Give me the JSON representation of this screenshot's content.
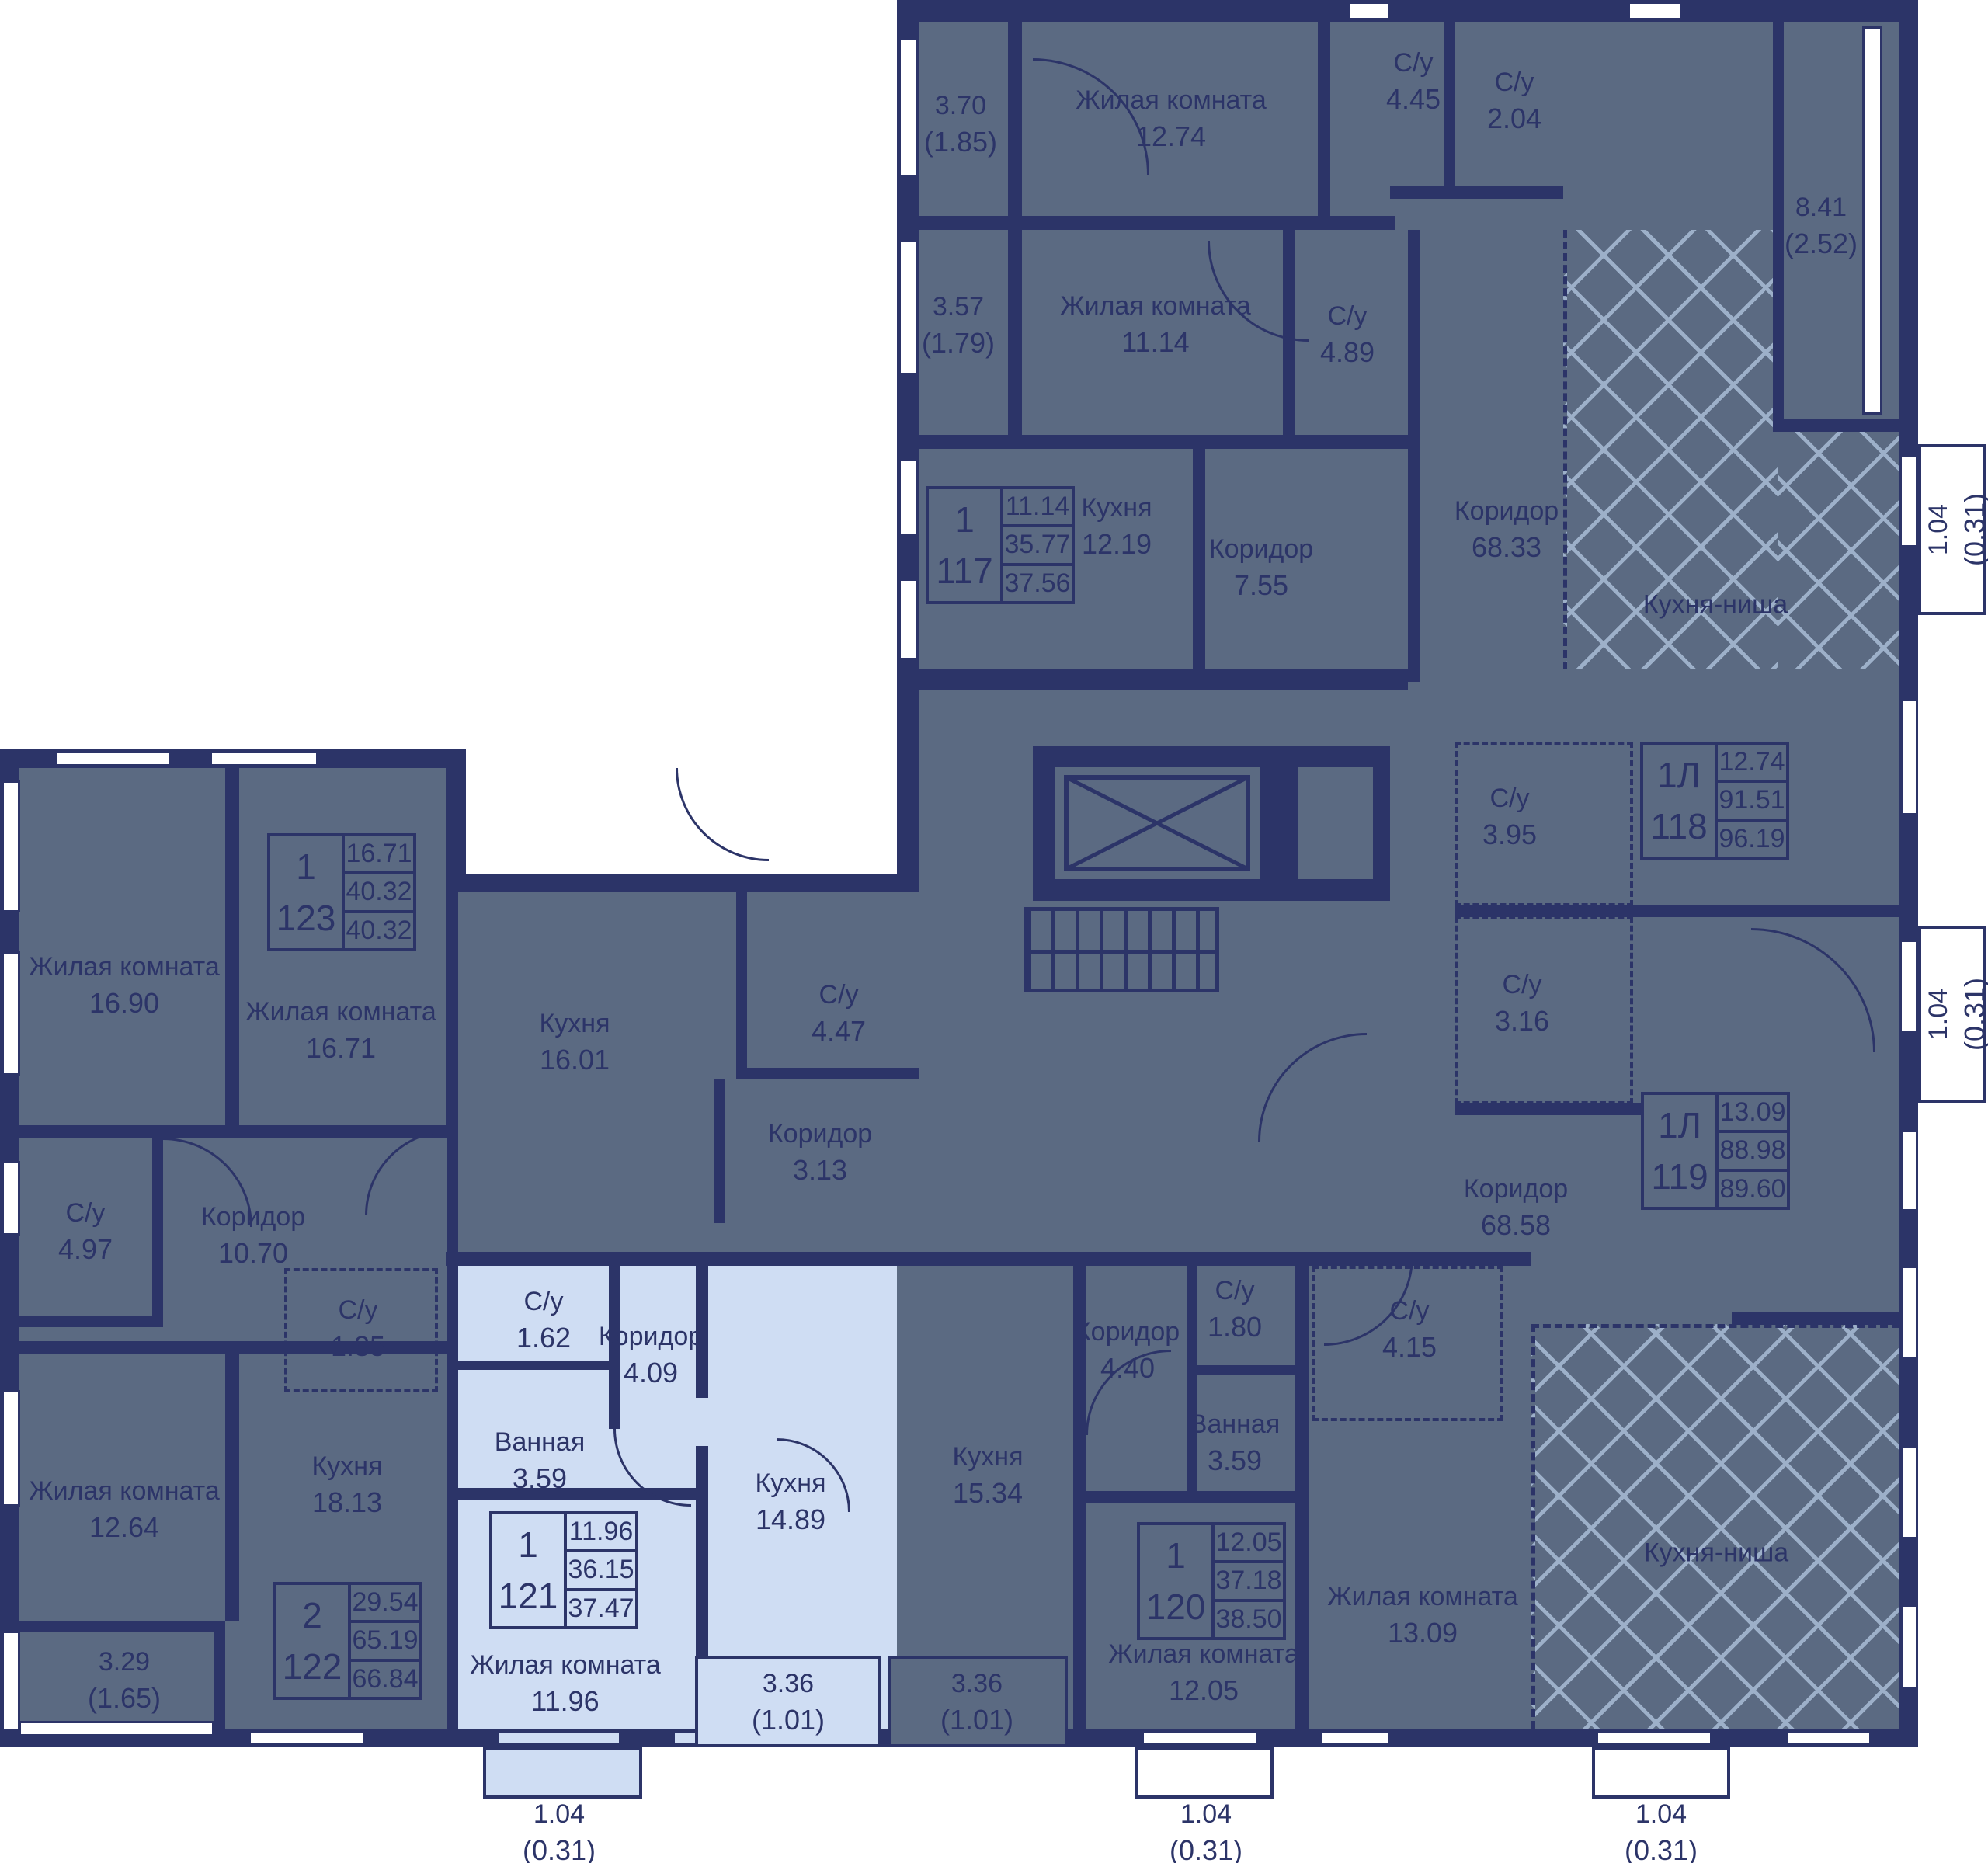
{
  "apartments": {
    "a117": {
      "type": "1",
      "number": "117",
      "living": "11.14",
      "area": "35.77",
      "total": "37.56"
    },
    "a118": {
      "type": "1Л",
      "number": "118",
      "living": "12.74",
      "area": "91.51",
      "total": "96.19"
    },
    "a119": {
      "type": "1Л",
      "number": "119",
      "living": "13.09",
      "area": "88.98",
      "total": "89.60"
    },
    "a120": {
      "type": "1",
      "number": "120",
      "living": "12.05",
      "area": "37.18",
      "total": "38.50"
    },
    "a121": {
      "type": "1",
      "number": "121",
      "living": "11.96",
      "area": "36.15",
      "total": "37.47"
    },
    "a122": {
      "type": "2",
      "number": "122",
      "living": "29.54",
      "area": "65.19",
      "total": "66.84"
    },
    "a123": {
      "type": "1",
      "number": "123",
      "living": "16.71",
      "area": "40.32",
      "total": "40.32"
    }
  },
  "rooms": {
    "zh1274": {
      "name": "Жилая комната",
      "area": "12.74"
    },
    "su445": {
      "name": "С/у",
      "area": "4.45"
    },
    "su204": {
      "name": "С/у",
      "area": "2.04"
    },
    "zh1114": {
      "name": "Жилая комната",
      "area": "11.14"
    },
    "su489": {
      "name": "С/у",
      "area": "4.89"
    },
    "k1219": {
      "name": "Кухня",
      "area": "12.19"
    },
    "kor755": {
      "name": "Коридор",
      "area": "7.55"
    },
    "kor6833": {
      "name": "Коридор",
      "area": "68.33"
    },
    "niche_top": {
      "name": "Кухня-ниша"
    },
    "su395": {
      "name": "С/у",
      "area": "3.95"
    },
    "su316": {
      "name": "С/у",
      "area": "3.16"
    },
    "kor6858": {
      "name": "Коридор",
      "area": "68.58"
    },
    "niche_bottom": {
      "name": "Кухня-ниша"
    },
    "zh1690": {
      "name": "Жилая комната",
      "area": "16.90"
    },
    "zh1671": {
      "name": "Жилая комната",
      "area": "16.71"
    },
    "k1601": {
      "name": "Кухня",
      "area": "16.01"
    },
    "su447": {
      "name": "С/у",
      "area": "4.47"
    },
    "kor313": {
      "name": "Коридор",
      "area": "3.13"
    },
    "su497": {
      "name": "С/у",
      "area": "4.97"
    },
    "kor1070": {
      "name": "Коридор",
      "area": "10.70"
    },
    "su185": {
      "name": "С/у",
      "area": "1.85"
    },
    "zh1264": {
      "name": "Жилая комната",
      "area": "12.64"
    },
    "k1813": {
      "name": "Кухня",
      "area": "18.13"
    },
    "su162": {
      "name": "С/у",
      "area": "1.62"
    },
    "kor409": {
      "name": "Коридор",
      "area": "4.09"
    },
    "van359a": {
      "name": "Ванная",
      "area": "3.59"
    },
    "k1489": {
      "name": "Кухня",
      "area": "14.89"
    },
    "zh1196": {
      "name": "Жилая комната",
      "area": "11.96"
    },
    "k1534": {
      "name": "Кухня",
      "area": "15.34"
    },
    "kor440": {
      "name": "Коридор",
      "area": "4.40"
    },
    "su180": {
      "name": "С/у",
      "area": "1.80"
    },
    "van359b": {
      "name": "Ванная",
      "area": "3.59"
    },
    "su415": {
      "name": "С/у",
      "area": "4.15"
    },
    "zh1205": {
      "name": "Жилая комната",
      "area": "12.05"
    },
    "zh1309": {
      "name": "Жилая комната",
      "area": "13.09"
    }
  },
  "balconies": {
    "b370": {
      "area": "3.70",
      "reduced": "(1.85)"
    },
    "b357": {
      "area": "3.57",
      "reduced": "(1.79)"
    },
    "b841": {
      "area": "8.41",
      "reduced": "(2.52)"
    },
    "b104_right_top": {
      "area": "1.04",
      "reduced": "(0.31)"
    },
    "b104_right_mid": {
      "area": "1.04",
      "reduced": "(0.31)"
    },
    "b329": {
      "area": "3.29",
      "reduced": "(1.65)"
    },
    "b336_left": {
      "area": "3.36",
      "reduced": "(1.01)"
    },
    "b336_right": {
      "area": "3.36",
      "reduced": "(1.01)"
    },
    "b104_bottom_1": {
      "area": "1.04",
      "reduced": "(0.31)"
    },
    "b104_bottom_2": {
      "area": "1.04",
      "reduced": "(0.31)"
    },
    "b104_bottom_3": {
      "area": "1.04",
      "reduced": "(0.31)"
    }
  },
  "colors": {
    "wall": "#2c3468",
    "floor": "#5b6a82",
    "highlight": "#cfddf3",
    "hatch": "#9db0c9"
  }
}
